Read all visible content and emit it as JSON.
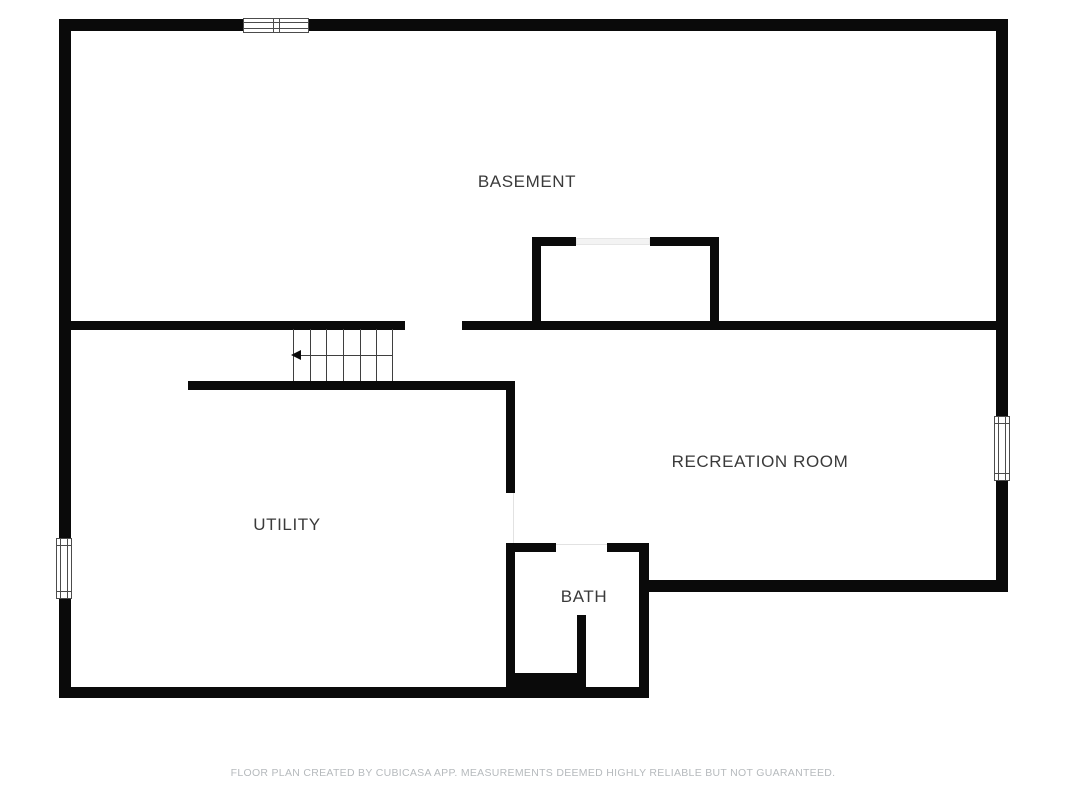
{
  "page": {
    "width": 1067,
    "height": 800,
    "background": "#ffffff"
  },
  "floorplan": {
    "rooms": [
      {
        "name": "BASEMENT"
      },
      {
        "name": "UTILITY"
      },
      {
        "name": "RECREATION ROOM"
      },
      {
        "name": "BATH"
      }
    ],
    "symbols": {
      "windows": [
        "top-wall-window",
        "left-wall-window",
        "right-wall-window"
      ],
      "stairs": {
        "tread_count": 6,
        "direction_arrow": "left"
      },
      "openings": [
        "basement-stairwell-opening",
        "stair-landing-opening",
        "utility-to-recreation-doorway",
        "bath-doorway"
      ]
    },
    "colors": {
      "wall": "#0a0a0a",
      "room_label": "#3a3a3a",
      "stair_line": "#3f3f3f",
      "footer_text": "#b6babd",
      "background": "#ffffff"
    }
  },
  "footer": {
    "text": "FLOOR PLAN CREATED BY CUBICASA APP. MEASUREMENTS DEEMED HIGHLY RELIABLE BUT NOT GUARANTEED."
  }
}
